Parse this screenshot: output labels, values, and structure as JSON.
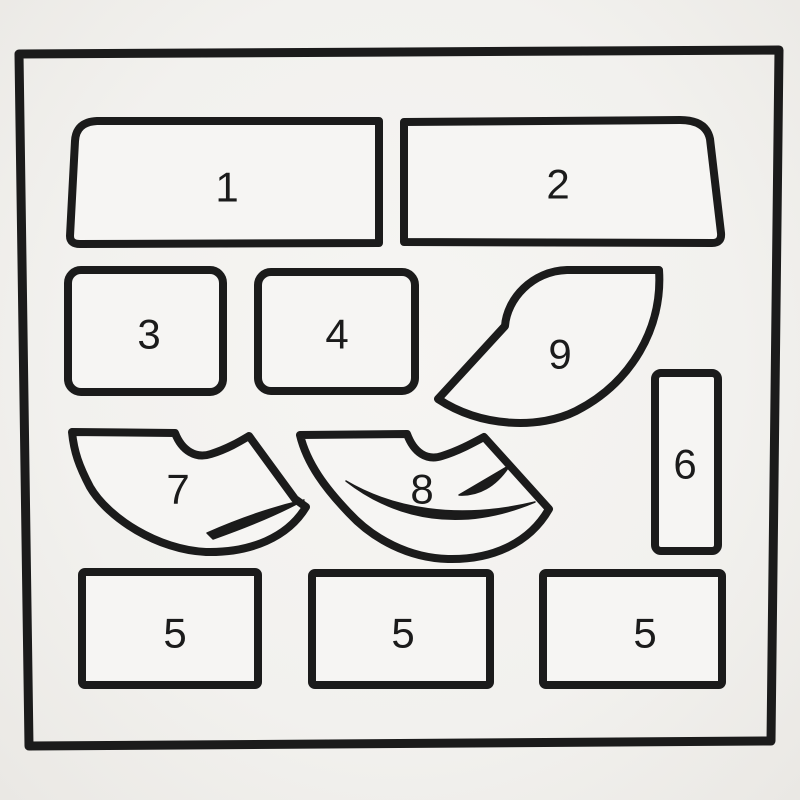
{
  "canvas": {
    "colors": {
      "paper": "#f2f1ee",
      "ink": "#1b1b1b",
      "piece-fill": "#f6f5f3"
    }
  },
  "pieces": [
    {
      "id": "piece-1",
      "label": "1",
      "shape": "wide panel, rounded top-left corner, slanted left edge"
    },
    {
      "id": "piece-2",
      "label": "2",
      "shape": "wide panel, rounded top-right corner, slanted right edge"
    },
    {
      "id": "piece-3",
      "label": "3",
      "shape": "rounded rectangle"
    },
    {
      "id": "piece-4",
      "label": "4",
      "shape": "rounded rectangle"
    },
    {
      "id": "piece-9",
      "label": "9",
      "shape": "curved fan segment with concave notch"
    },
    {
      "id": "piece-6",
      "label": "6",
      "shape": "tall narrow rectangle"
    },
    {
      "id": "piece-7",
      "label": "7",
      "shape": "curved fan segment with notch and crescent marking"
    },
    {
      "id": "piece-8",
      "label": "8",
      "shape": "curved fan segment with notch and crescent markings"
    },
    {
      "id": "piece-5a",
      "label": "5",
      "shape": "rectangle"
    },
    {
      "id": "piece-5b",
      "label": "5",
      "shape": "rectangle"
    },
    {
      "id": "piece-5c",
      "label": "5",
      "shape": "rectangle"
    }
  ]
}
